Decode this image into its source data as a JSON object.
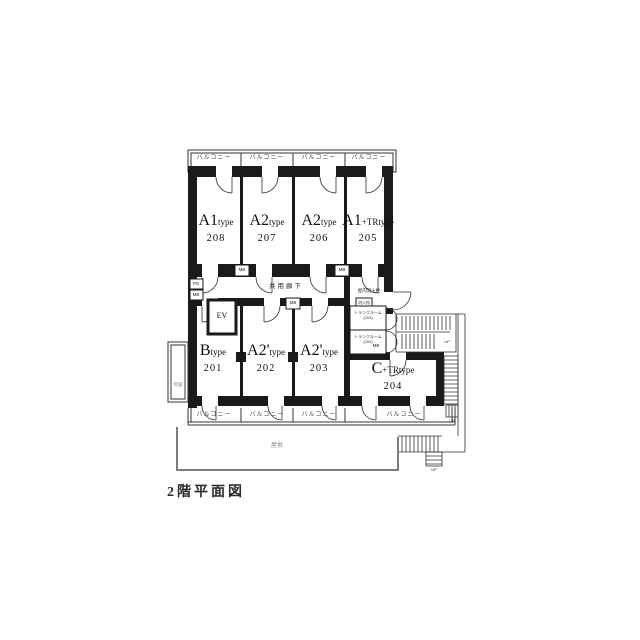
{
  "title": "2階平面図",
  "colors": {
    "wall": "#1a1a1a",
    "line": "#333333",
    "roof_line": "#7d7d7d"
  },
  "units": [
    {
      "big": "A1",
      "small": "type",
      "number": "208"
    },
    {
      "big": "A2",
      "small": "type",
      "number": "207"
    },
    {
      "big": "A2",
      "small": "type",
      "number": "206"
    },
    {
      "big": "A1",
      "small": "+TRtype",
      "number": "205"
    },
    {
      "big": "B",
      "small": "type",
      "number": "201"
    },
    {
      "big": "A2'",
      "small": "type",
      "number": "202"
    },
    {
      "big": "A2'",
      "small": "type",
      "number": "203"
    },
    {
      "big": "C",
      "small": "+TRtype",
      "number": "204"
    }
  ],
  "labels": {
    "balcony": "バルコニー",
    "corridor": "共用廊下",
    "elevator": "EV",
    "meter_box": "MB",
    "pipe_space": "PS",
    "fire_hydrant": "屋内消火栓",
    "fire_hydrant_box": "消火栓",
    "trunk_room": "トランクルーム",
    "trunk_203_no": "(203)",
    "trunk_204_no": "(204)",
    "storage": "物置",
    "roof": "屋根",
    "up": "UP"
  }
}
